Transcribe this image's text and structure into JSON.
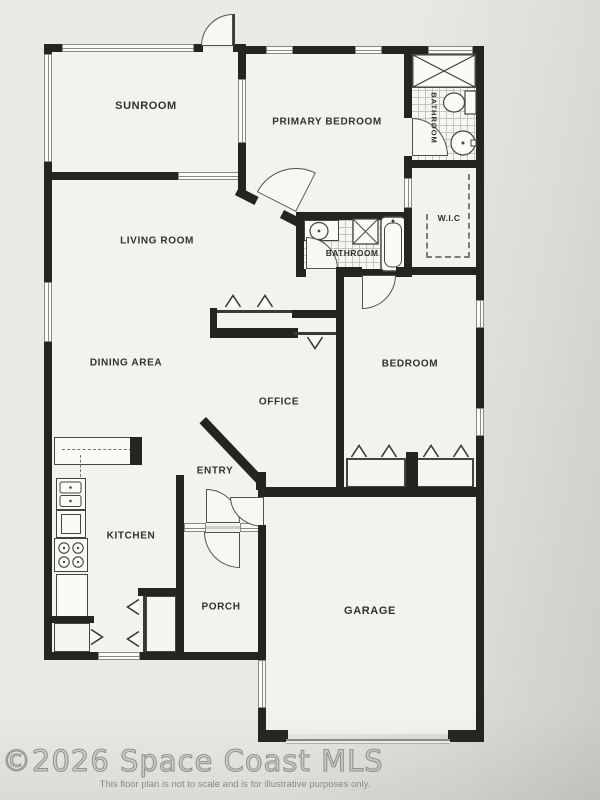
{
  "floorplan": {
    "rooms": {
      "sunroom": "SUNROOM",
      "primary_bedroom": "PRIMARY BEDROOM",
      "primary_bathroom": "BATHROOM",
      "wic": "W.I.C",
      "living_room": "LIVING ROOM",
      "hall_bathroom": "BATHROOM",
      "dining_area": "DINING AREA",
      "bedroom": "BEDROOM",
      "office": "OFFICE",
      "entry": "ENTRY",
      "kitchen": "KITCHEN",
      "porch": "PORCH",
      "garage": "GARAGE"
    },
    "watermark": "©2026 Space Coast MLS",
    "disclaimer": "This floor plan is not to scale and is for illustrative purposes only.",
    "colors": {
      "wall": "#26241f",
      "paper": "#eae9e5",
      "floor": "#f3f2ee",
      "window_line": "#8a8883",
      "watermark_gray": "#979693"
    }
  }
}
